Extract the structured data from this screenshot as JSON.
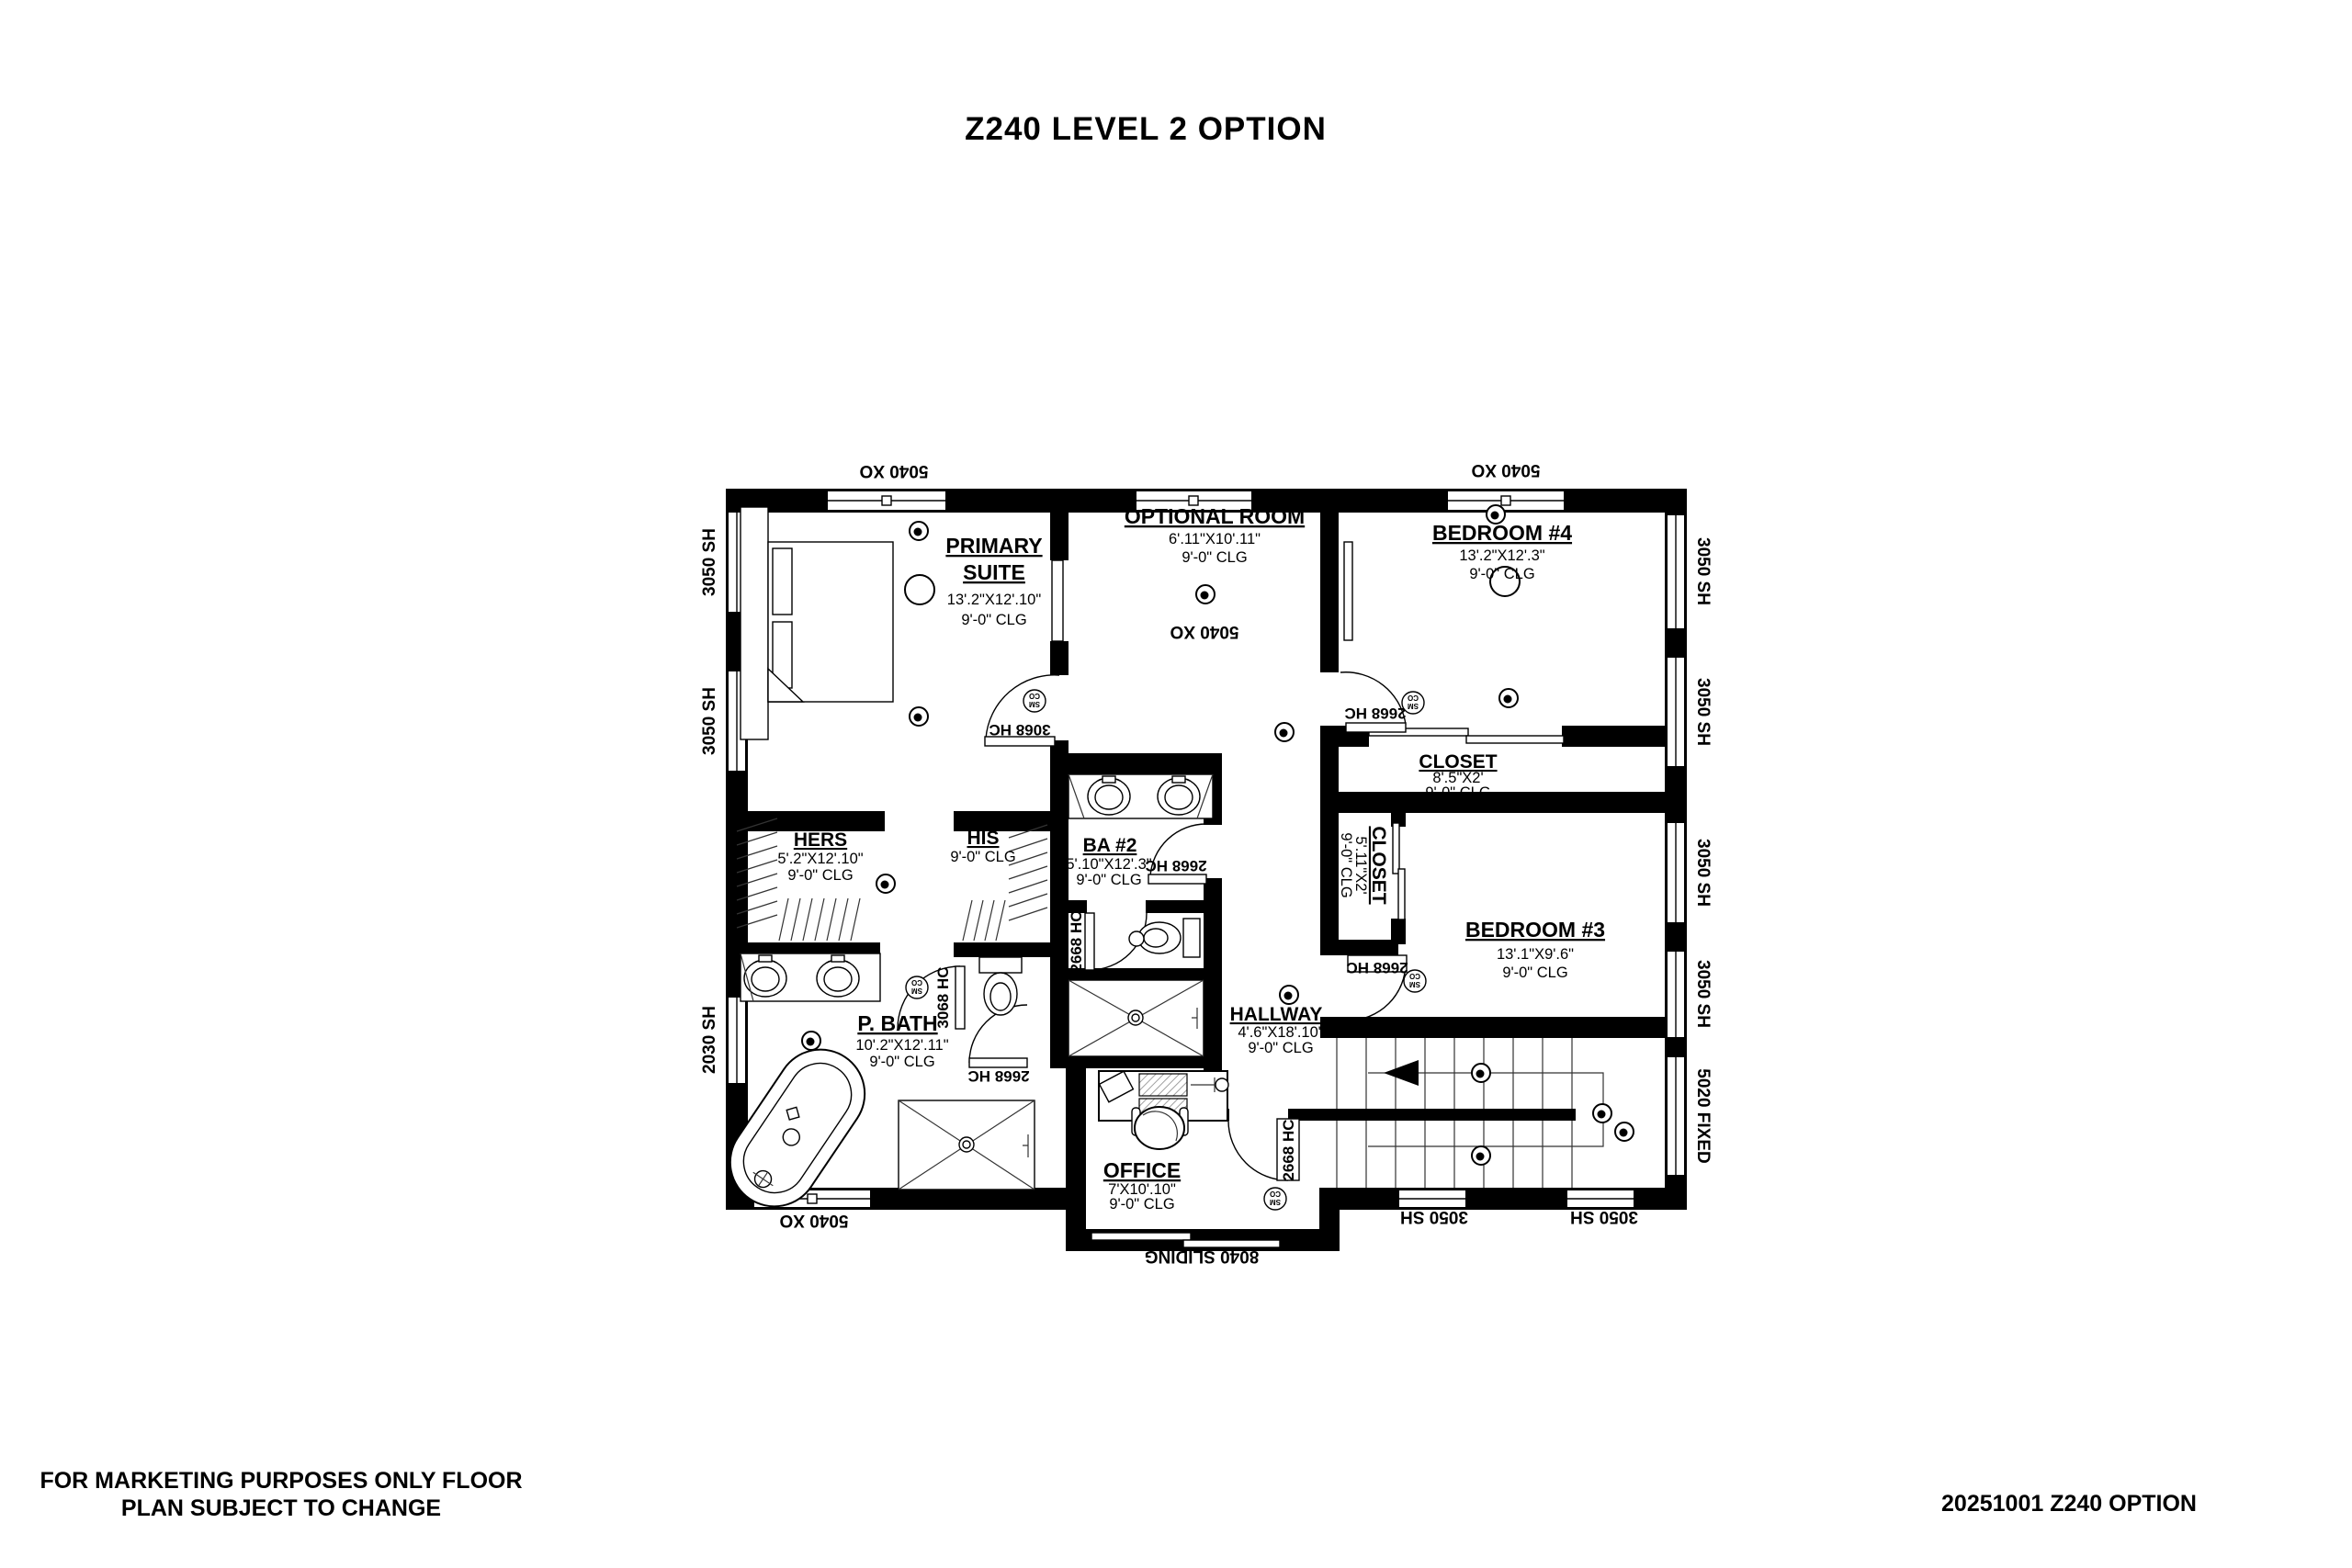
{
  "title": "Z240 LEVEL 2 OPTION",
  "footer": {
    "left_line1": "FOR MARKETING PURPOSES ONLY FLOOR",
    "left_line2": "PLAN SUBJECT TO CHANGE",
    "right": "20251001 Z240 OPTION"
  },
  "rooms": {
    "primary_suite": {
      "name1": "PRIMARY",
      "name2": "SUITE",
      "dim": "13'.2\"X12'.10\"",
      "clg": "9'-0\" CLG"
    },
    "optional_room": {
      "name": "OPTIONAL ROOM",
      "dim": "6'.11\"X10'.11\"",
      "clg": "9'-0\" CLG"
    },
    "bedroom4": {
      "name": "BEDROOM #4",
      "dim": "13'.2\"X12'.3\"",
      "clg": "9'-0\" CLG"
    },
    "closet4": {
      "name": "CLOSET",
      "dim": "8'.5\"X2'",
      "clg": "9'-0\" CLG"
    },
    "hers": {
      "name": "HERS",
      "dim": "5'.2\"X12'.10\"",
      "clg": "9'-0\" CLG"
    },
    "his": {
      "name": "HIS",
      "clg": "9'-0\" CLG"
    },
    "ba2": {
      "name": "BA #2",
      "dim": "5'.10\"X12'.3\"",
      "clg": "9'-0\" CLG"
    },
    "closet3": {
      "name": "CLOSET",
      "dim": "5'.11\"X2'",
      "clg": "9'-0\" CLG"
    },
    "bedroom3": {
      "name": "BEDROOM #3",
      "dim": "13'.1\"X9'.6\"",
      "clg": "9'-0\" CLG"
    },
    "pbath": {
      "name": "P. BATH",
      "dim": "10'.2\"X12'.11\"",
      "clg": "9'-0\" CLG"
    },
    "hallway": {
      "name": "HALLWAY",
      "dim": "4'.6\"X18'.10\"",
      "clg": "9'-0\" CLG"
    },
    "office": {
      "name": "OFFICE",
      "dim": "7'X10'.10\"",
      "clg": "9'-0\" CLG"
    }
  },
  "windows": {
    "w5040": "5040 XO",
    "w3050": "3050 SH",
    "w2030": "2030 SH",
    "w5020": "5020 FIXED",
    "w8040": "8040 SLIDING"
  },
  "doors": {
    "d3068": "3068 HC",
    "d2668": "2668 HC"
  },
  "detector": {
    "line1": "SM",
    "line2": "CO"
  }
}
